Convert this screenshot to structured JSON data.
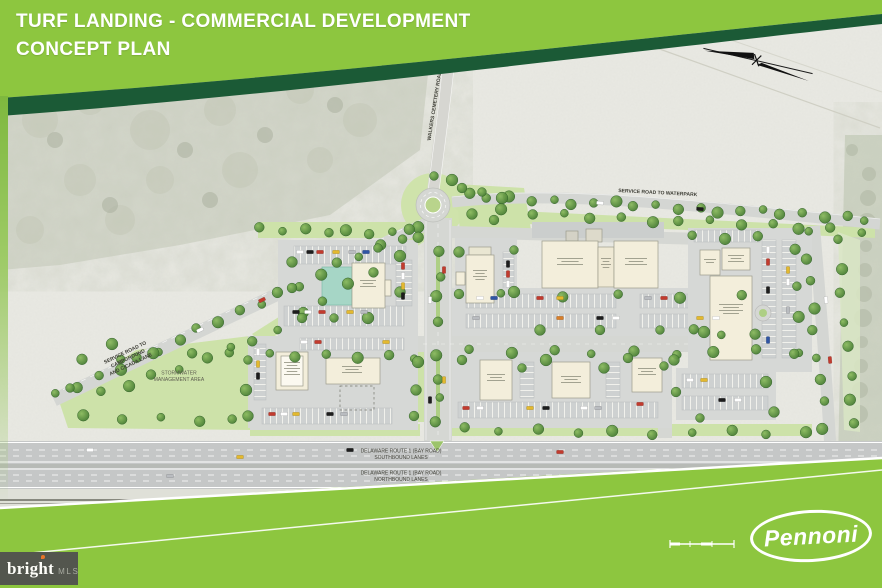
{
  "header": {
    "title": "TURF LANDING - COMMERCIAL DEVELOPMENT\nCONCEPT PLAN",
    "banner_color": "#8dc63f",
    "swoosh_color": "#1b5a36"
  },
  "plan_labels": {
    "service_road_left": "SERVICE ROAD TO CAMPGROUND\nAND CICADA LANE",
    "service_road_right": "SERVICE ROAD TO WATERPARK",
    "cemetery_road": "WALKERS CEMETERY ROAD",
    "stormwater": "STORMWATER\nMANAGEMENT AREA",
    "route1_southbound": "DELAWARE ROUTE 1 (BAY ROAD)\nSOUTHBOUND LANES",
    "route1_northbound": "DELAWARE ROUTE 1 (BAY ROAD)\nNORTHBOUND LANES"
  },
  "footer": {
    "logo_text": "Pennoni",
    "green_color": "#8dc63f"
  },
  "watermark": {
    "brand": "bright",
    "suffix": "MLS"
  }
}
